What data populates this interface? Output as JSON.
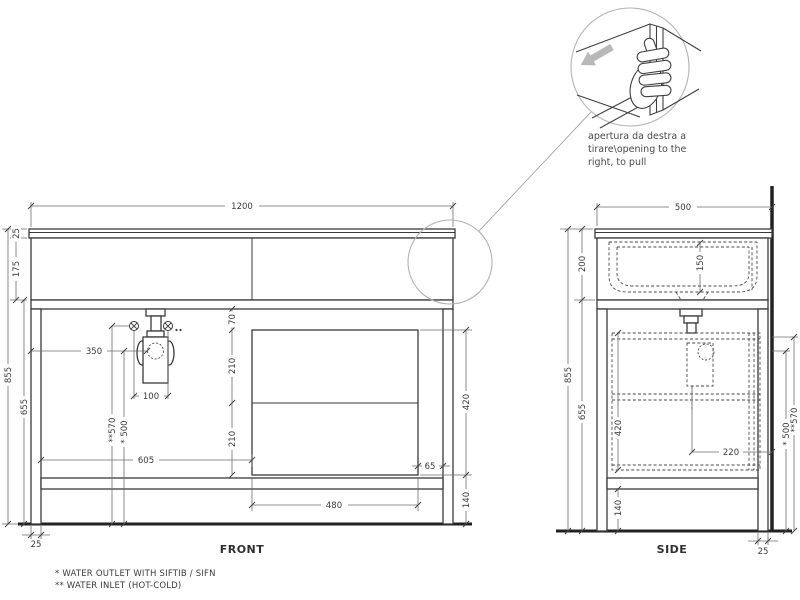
{
  "front": {
    "label": "FRONT",
    "dim_width": "1200",
    "dim_top_thickness": "25",
    "dim_band_height": "175",
    "dim_total_height": "855",
    "dim_lower_height": "655",
    "dim_trap_offset": "350",
    "dim_inlet_spacing": "100",
    "dim_inlet_height": "**570",
    "dim_outlet_height": "* 500",
    "dim_box_offset": "605",
    "dim_shelf_gap": "70",
    "dim_drawer_upper": "210",
    "dim_drawer_lower": "210",
    "dim_box_height": "420",
    "dim_gap_right": "65",
    "dim_bottom_clearance": "140",
    "dim_box_width": "480",
    "dim_leg_width": "25"
  },
  "side": {
    "label": "SIDE",
    "dim_depth": "500",
    "dim_top_section": "200",
    "dim_basin_depth": "150",
    "dim_total_height": "855",
    "dim_lower_height": "655",
    "dim_box_height": "420",
    "dim_drain_offset": "220",
    "dim_bottom_clearance": "140",
    "dim_outlet_height": "* 500",
    "dim_inlet_height": "**570",
    "dim_leg_width": "25"
  },
  "detail": {
    "caption_line1": "apertura da destra a",
    "caption_line2": "tirare\\opening to the",
    "caption_line3": "right, to pull"
  },
  "notes": {
    "outlet": "*  WATER OUTLET WITH SIFTIB / SIFN",
    "inlet": "** WATER INLET (HOT-COLD)"
  },
  "colors": {
    "line": "#3a3a3a",
    "arrow": "#b8b8b8",
    "detail_circle": "#b3b3b3"
  }
}
